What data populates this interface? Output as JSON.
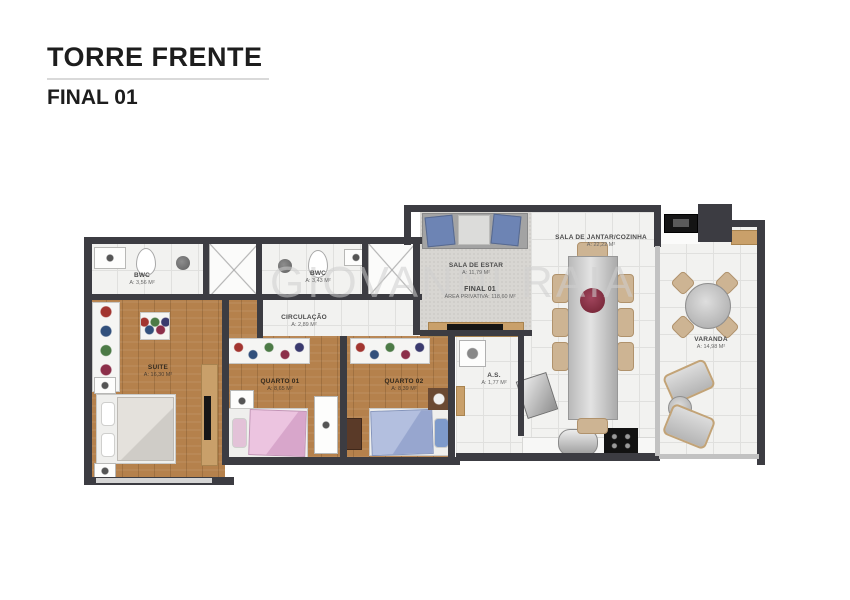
{
  "title": {
    "main": "TORRE FRENTE",
    "sub": "FINAL 01"
  },
  "watermark": "GIOVANNI RAIA",
  "unit_summary": {
    "label": "FINAL 01",
    "area": "ÁREA PRIVATIVA: 118,60 M²"
  },
  "rooms": {
    "bwc_suite": {
      "name": "BWC",
      "area": "A: 3,56 M²"
    },
    "bwc_social": {
      "name": "BWC",
      "area": "A: 3,43 M²"
    },
    "circulacao": {
      "name": "CIRCULAÇÃO",
      "area": "A: 2,89 M²"
    },
    "sala_de_estar": {
      "name": "SALA DE ESTAR",
      "area": "A: 11,79 M²"
    },
    "sala_de_jantar_cozinha": {
      "name": "SALA DE JANTAR/COZINHA",
      "area": "A: 22,22 M²"
    },
    "varanda": {
      "name": "VARANDA",
      "area": "A: 14,98 M²"
    },
    "suite": {
      "name": "SUITE",
      "area": "A: 16,30 M²"
    },
    "quarto_01": {
      "name": "QUARTO 01",
      "area": "A: 8,65 M²"
    },
    "quarto_02": {
      "name": "QUARTO 02",
      "area": "A: 8,39 M²"
    },
    "area_servico": {
      "name": "A.S.",
      "area": "A: 1,77 M²"
    }
  },
  "colors": {
    "wall": "#3c3c42",
    "wood_floor": "#b5814c",
    "tile_floor": "#f2f2f0",
    "carpet": "#d8d6d2",
    "accent_wood": "#c9a06a",
    "bed_pink": "#e4b8da",
    "bed_blue": "#a9b6d9",
    "flower_centerpiece": "#6e2030",
    "sofa_blue": "#6d84b4"
  }
}
